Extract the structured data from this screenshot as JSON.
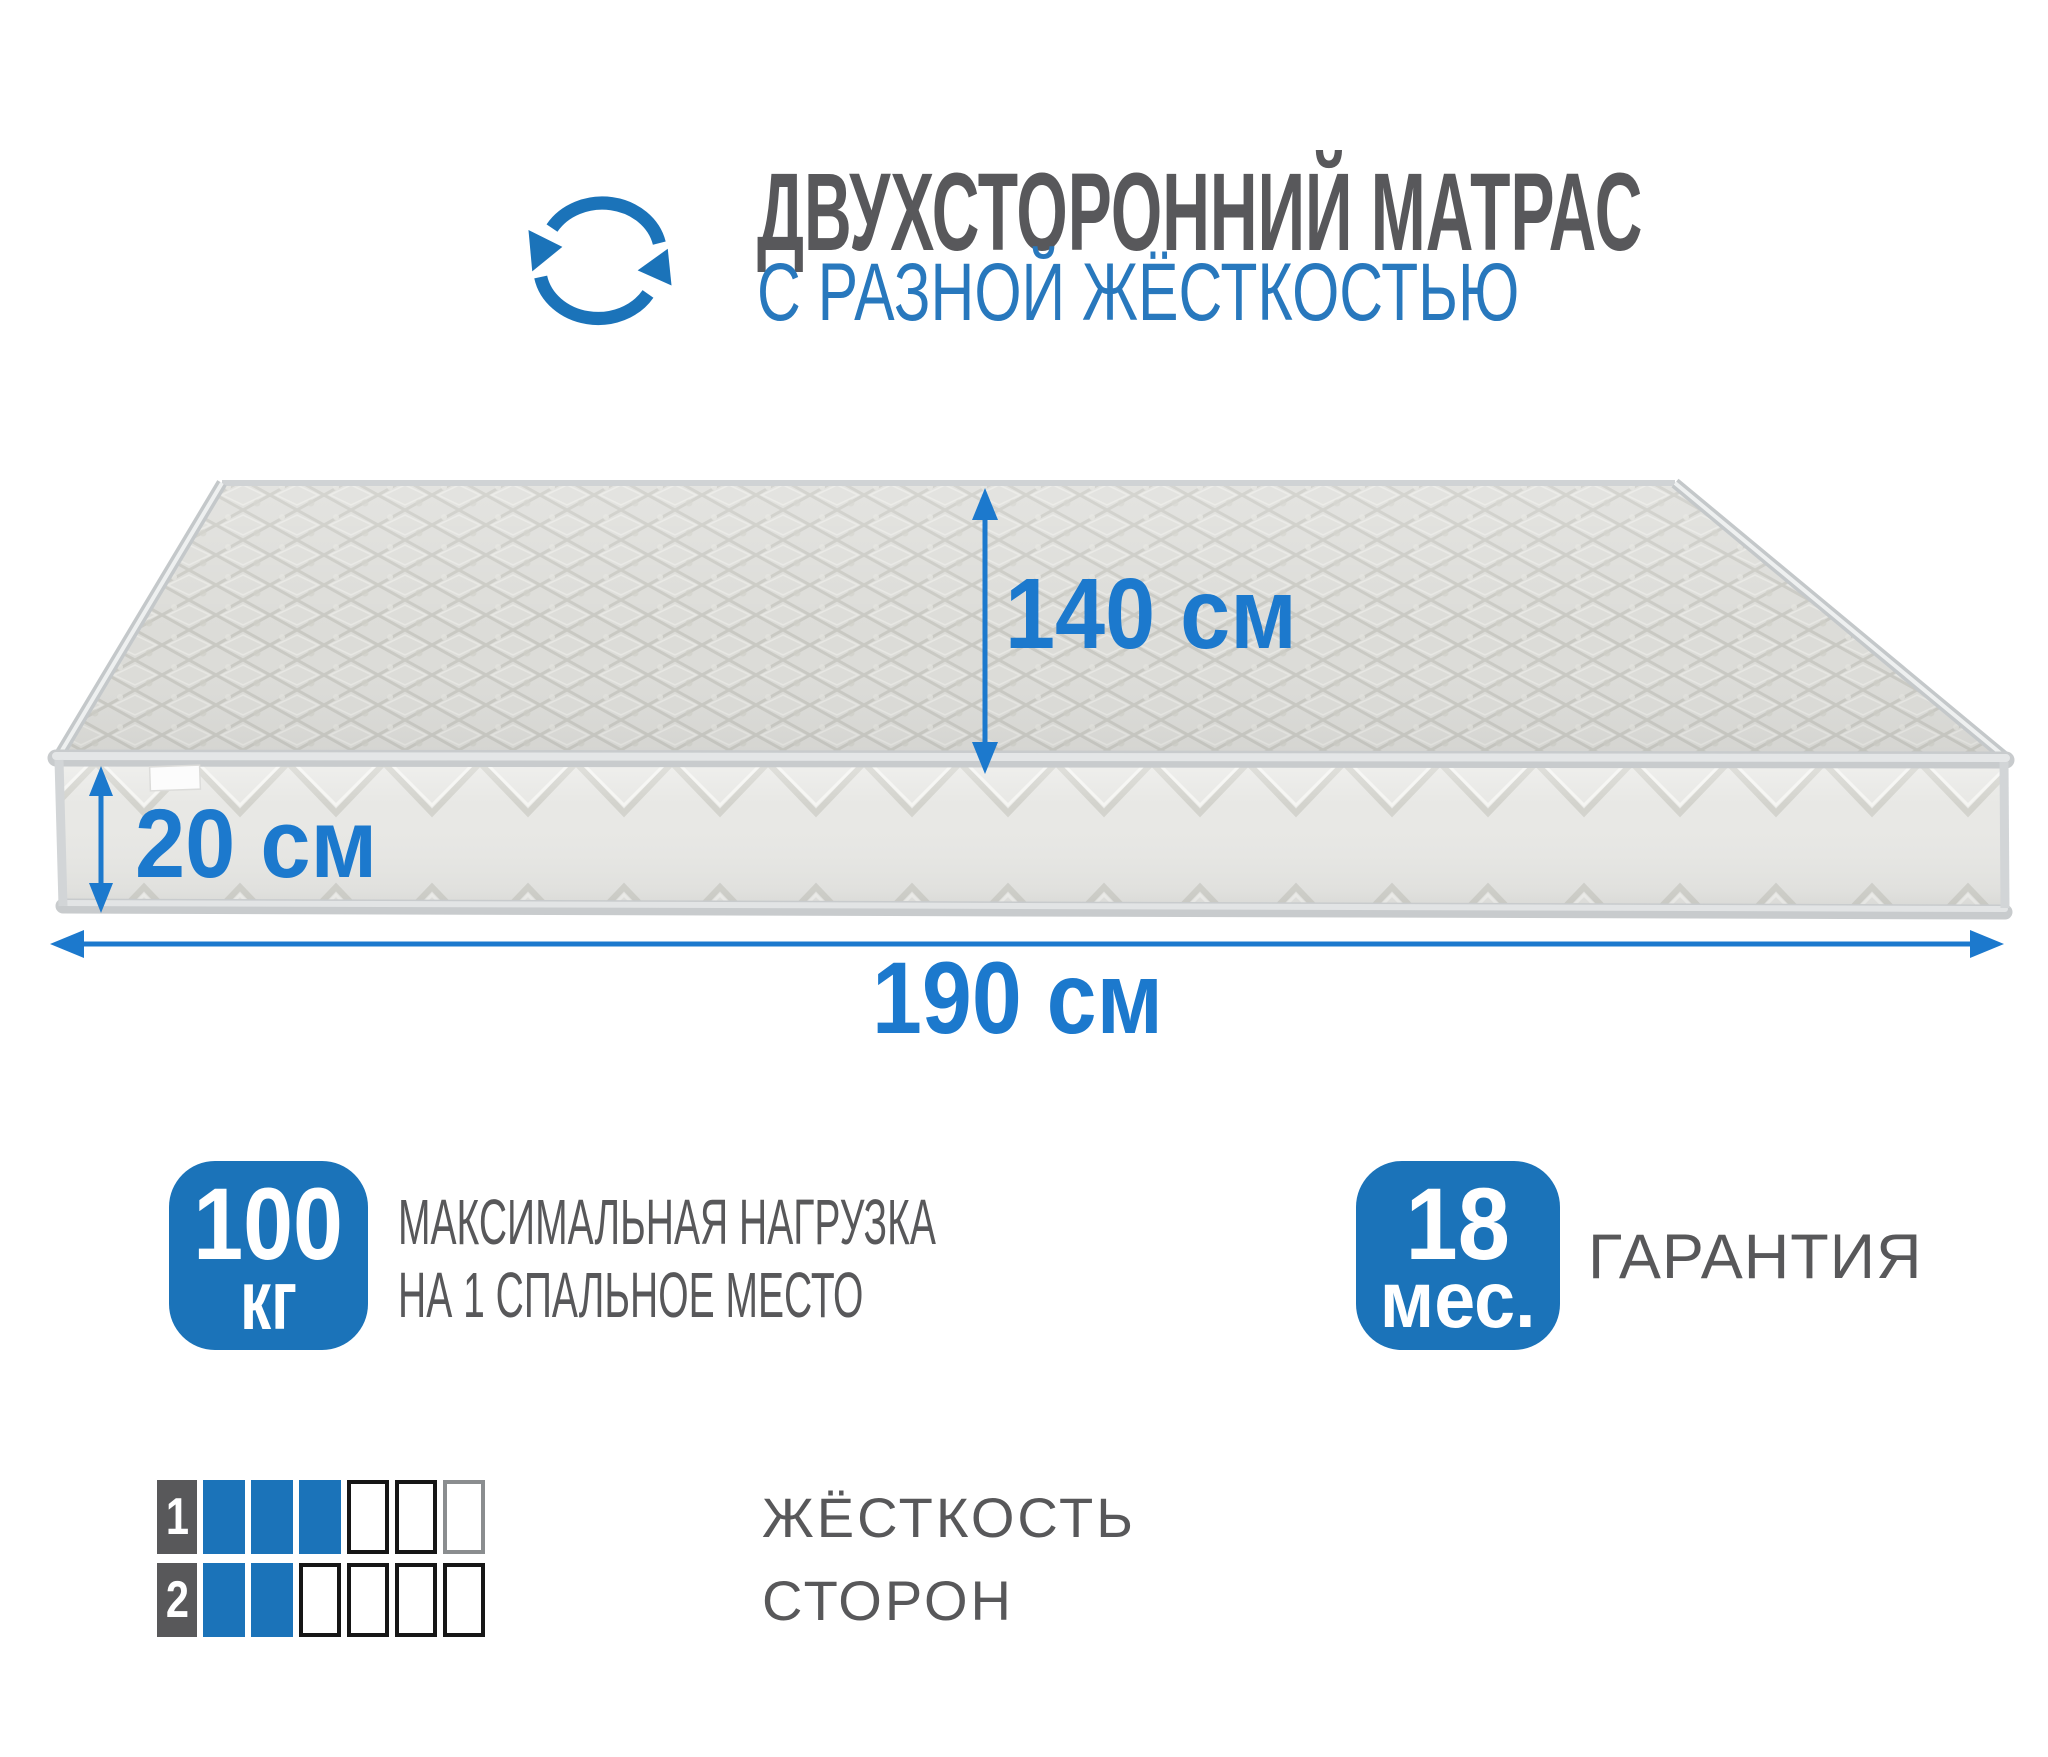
{
  "header": {
    "title_line1": "ДВУХСТОРОННИЙ МАТРАС",
    "title_line2": "С РАЗНОЙ ЖЁСТКОСТЬЮ"
  },
  "dimensions": {
    "depth": "140 см",
    "height": "20 см",
    "length": "190 см"
  },
  "badges": {
    "load": {
      "value": "100",
      "unit": "кг",
      "label_line1": "МАКСИМАЛЬНАЯ НАГРУЗКА",
      "label_line2": "НА 1 СПАЛЬНОЕ МЕСТО"
    },
    "warranty": {
      "value": "18",
      "unit": "мес.",
      "label": "ГАРАНТИЯ"
    }
  },
  "firmness": {
    "label_line1": "ЖЁСТКОСТЬ",
    "label_line2": "СТОРОН",
    "rows": [
      {
        "side": "1",
        "filled": 3,
        "total": 6
      },
      {
        "side": "2",
        "filled": 2,
        "total": 6
      }
    ]
  },
  "colors": {
    "accent_blue": "#1b73b9",
    "dimension_blue": "#1c79cd",
    "header_blue": "#2878bd",
    "text_gray": "#58585a"
  }
}
